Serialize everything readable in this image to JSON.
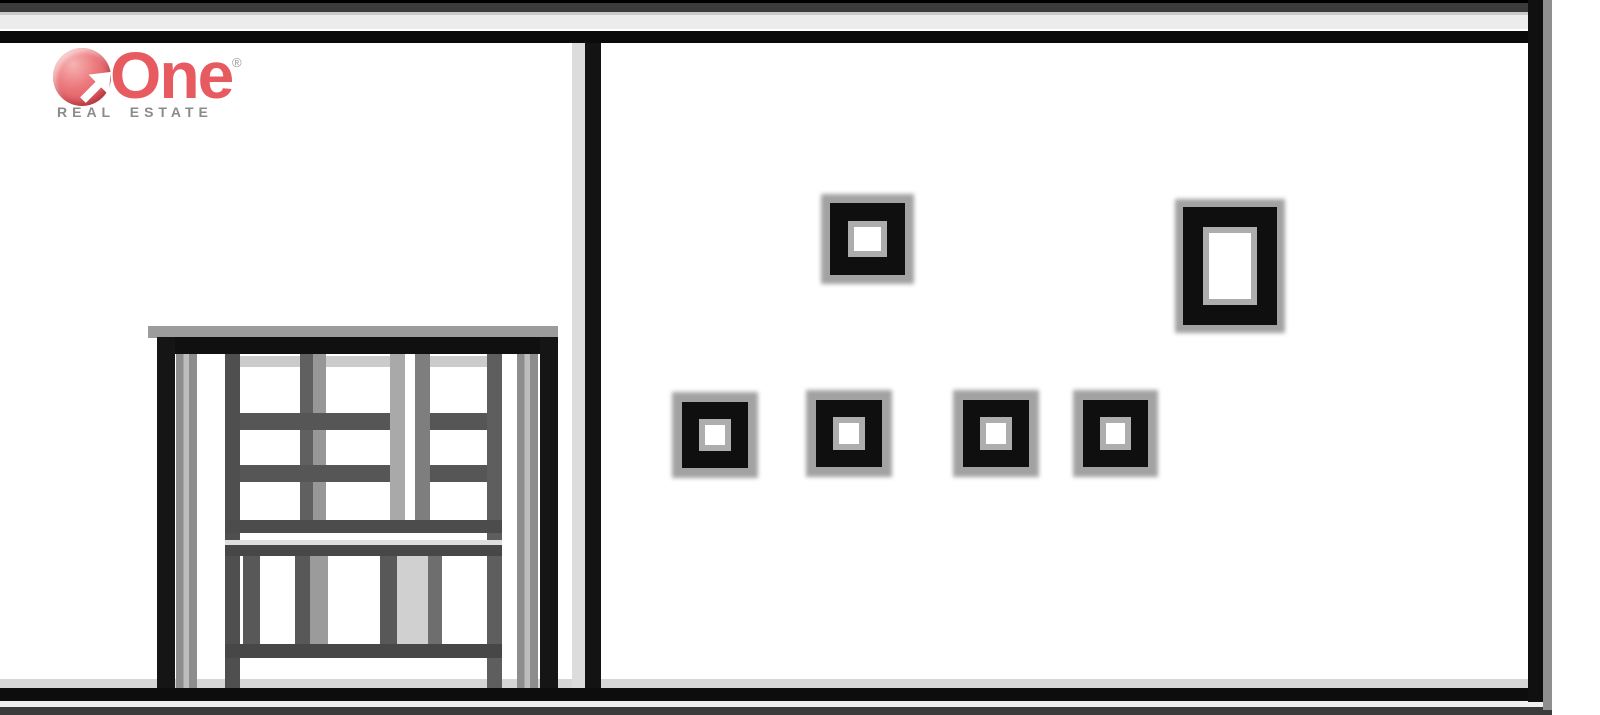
{
  "logo": {
    "brand": "One",
    "registered_mark": "®",
    "tagline": "REAL ESTATE",
    "brand_color": "#e75a60",
    "tagline_color": "#8b8b8b"
  },
  "drawing": {
    "kind": "building front elevation, black line art on white",
    "ink_color": "#111111",
    "shadow_color": "#a2a2a2",
    "wall_color": "#ffffff",
    "left_wall": "entry door with glazed grid top and slatted lower panels",
    "right_wall": "six black-framed windows",
    "window_frame_color": "#0f0f0f",
    "window_halo_color": "#a2a2a2",
    "windows": [
      {
        "id": "upper-left",
        "x": 830,
        "y": 203,
        "w": 75,
        "h": 72,
        "border": 18,
        "halo": 9
      },
      {
        "id": "upper-right",
        "x": 1183,
        "y": 207,
        "w": 94,
        "h": 118,
        "border": 20,
        "halo": 8
      },
      {
        "id": "lower-1",
        "x": 682,
        "y": 402,
        "w": 66,
        "h": 66,
        "border": 17,
        "halo": 10
      },
      {
        "id": "lower-2",
        "x": 816,
        "y": 400,
        "w": 66,
        "h": 67,
        "border": 17,
        "halo": 10
      },
      {
        "id": "lower-3",
        "x": 963,
        "y": 400,
        "w": 66,
        "h": 67,
        "border": 17,
        "halo": 10
      },
      {
        "id": "lower-4",
        "x": 1083,
        "y": 400,
        "w": 65,
        "h": 67,
        "border": 17,
        "halo": 10
      }
    ]
  }
}
